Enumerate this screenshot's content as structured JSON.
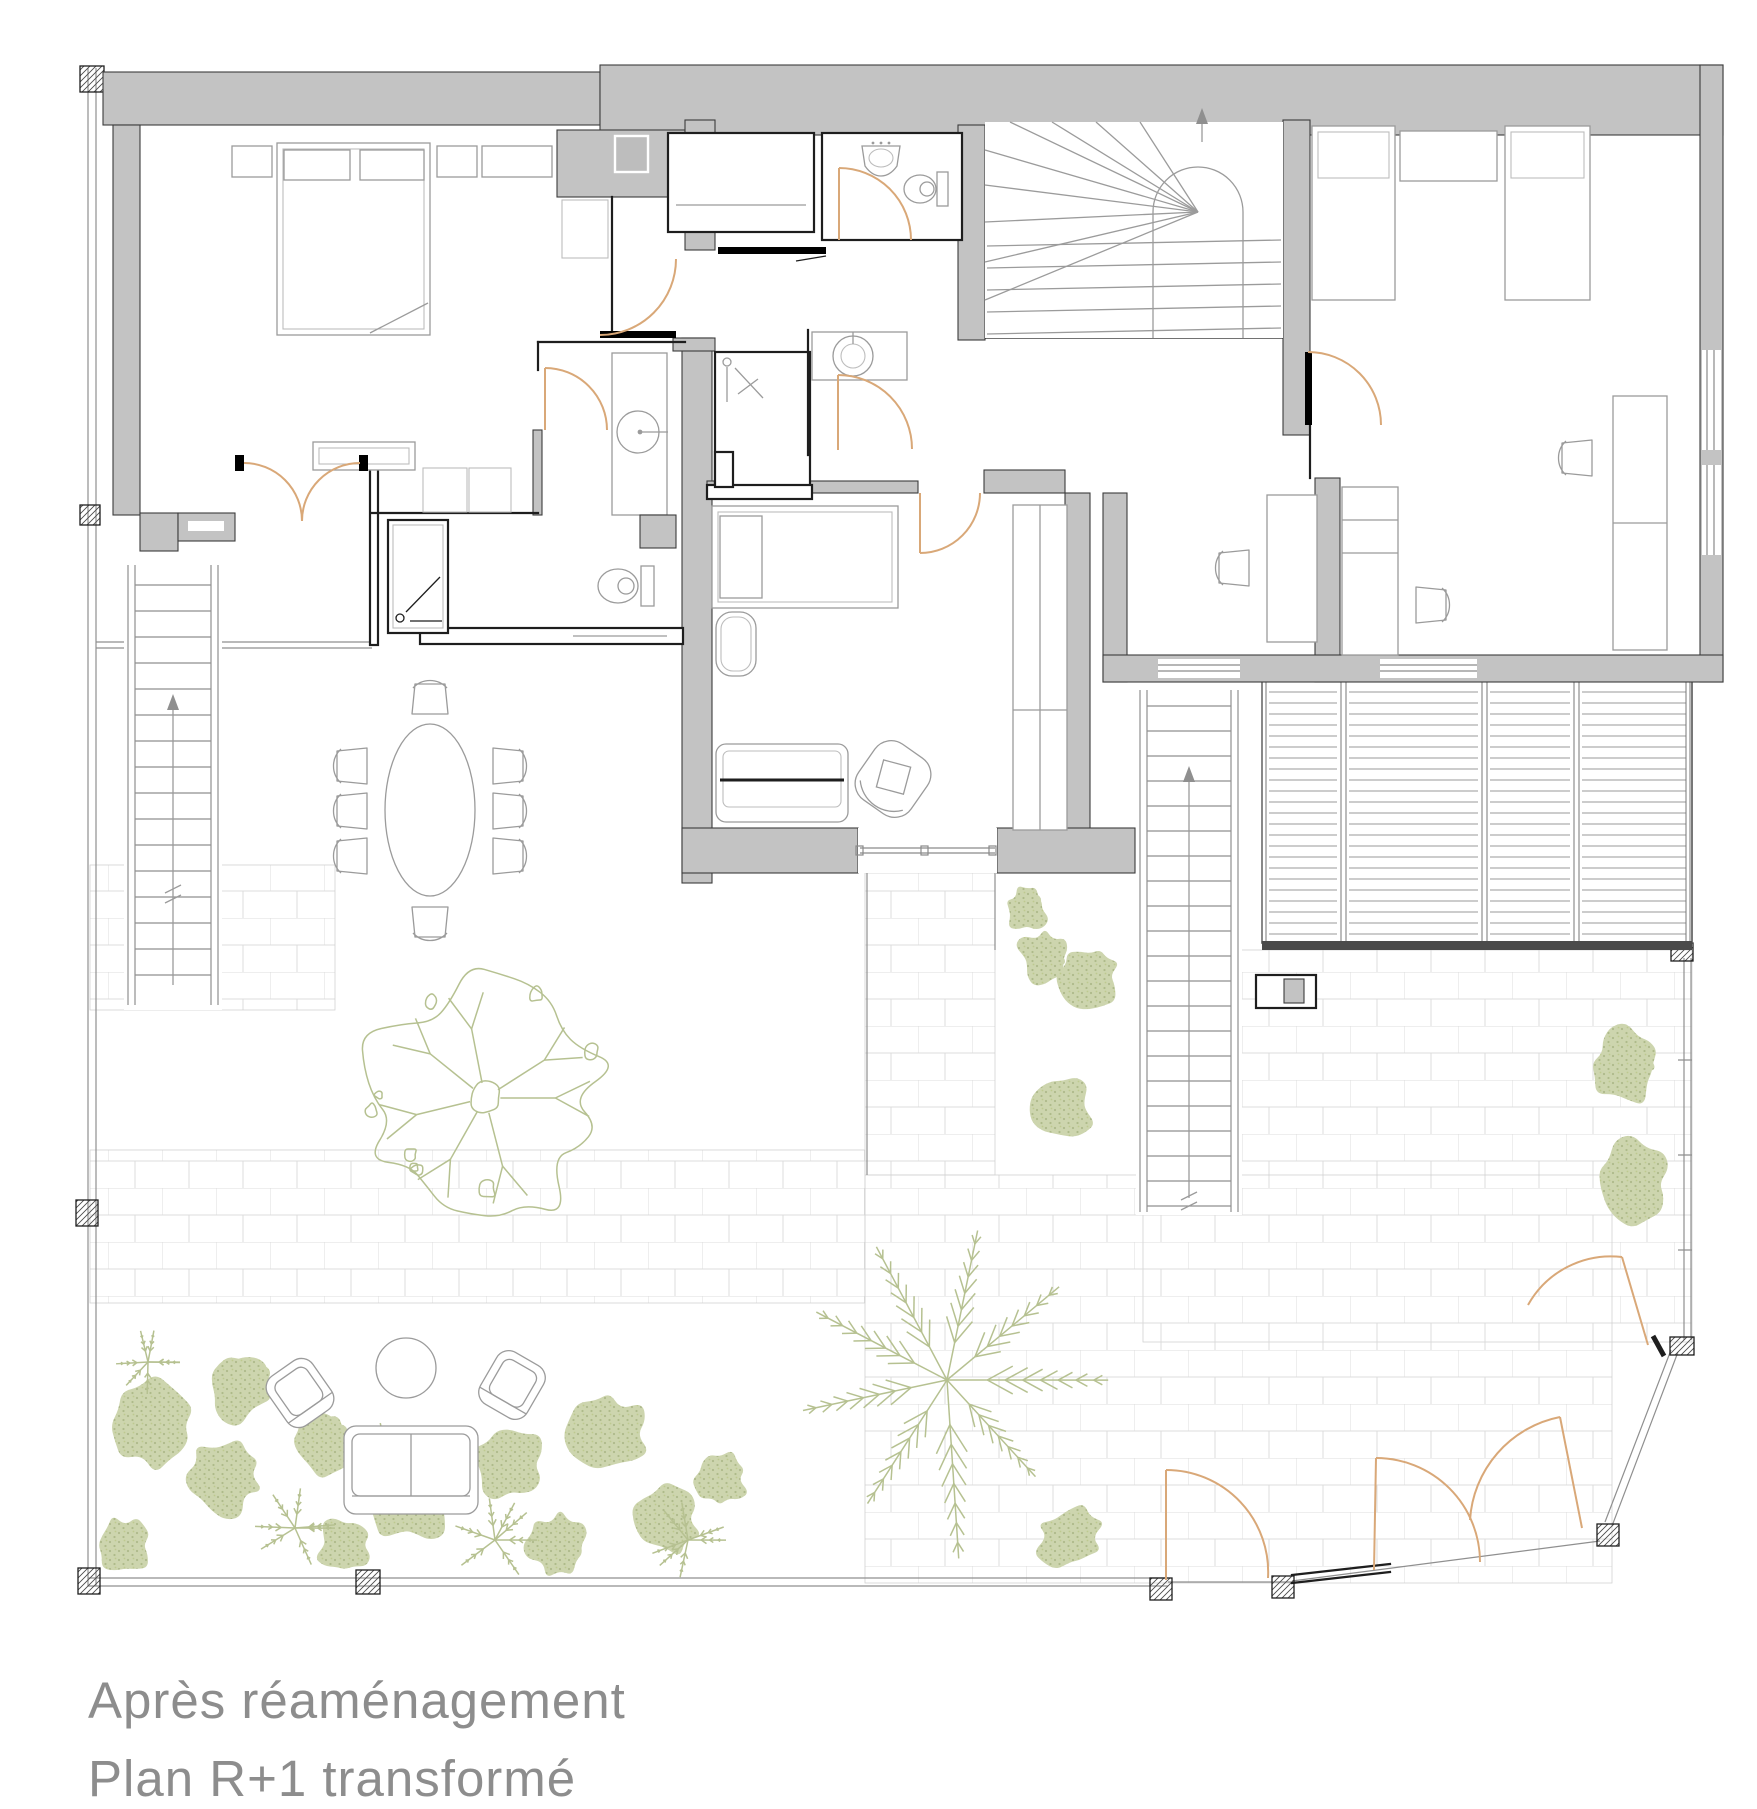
{
  "caption": {
    "line1": "Après réaménagement",
    "line2": "Plan R+1 transformé"
  },
  "palette": {
    "background": "#ffffff",
    "wall_fill": "#c3c3c3",
    "wall_outline": "#3c3c3c",
    "line_black": "#1e1e1e",
    "furniture_line": "#9b9b9b",
    "furniture_light": "#bdbdbd",
    "door_arc": "#d9a878",
    "vegetation": "#ccd4ad",
    "vegetation_dark": "#b6c191",
    "paver_line": "#dcdcdc",
    "glazing": "#8a8a8a",
    "caption_text": "#8d8d8d"
  }
}
